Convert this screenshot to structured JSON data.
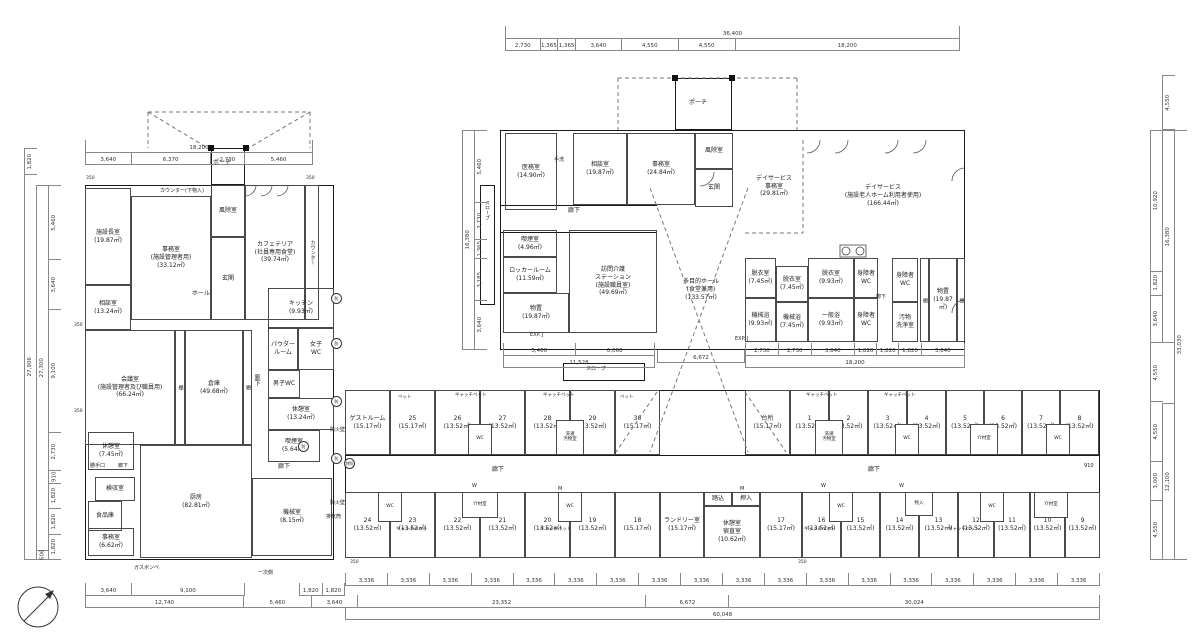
{
  "colors": {
    "background": "#ffffff",
    "line": "#1a1a1a",
    "dim_text": "#333333"
  },
  "rooms": {
    "left": [
      {
        "id": "director-room",
        "lines": [
          "施設長室",
          "(19.87㎡)"
        ]
      },
      {
        "id": "office-admin",
        "lines": [
          "事務室",
          "(施設管理者用)",
          "(33.12㎡)"
        ]
      },
      {
        "id": "windbreak-left",
        "lines": [
          "風除室"
        ]
      },
      {
        "id": "entrance-left",
        "lines": [
          "玄関"
        ]
      },
      {
        "id": "cafeteria",
        "lines": [
          "カフェテリア",
          "(社員専用食堂)",
          "(39.74㎡)"
        ]
      },
      {
        "id": "counter-strip",
        "lines": [
          "カウンター"
        ]
      },
      {
        "id": "consult-left",
        "lines": [
          "相談室",
          "(13.24㎡)"
        ]
      },
      {
        "id": "meeting-room",
        "lines": [
          "会議室",
          "(施設管理者及び職員用)",
          "(66.24㎡)"
        ]
      },
      {
        "id": "shelf-a",
        "lines": [
          "棚"
        ]
      },
      {
        "id": "storage-main",
        "lines": [
          "倉庫",
          "(49.68㎡)"
        ]
      },
      {
        "id": "shelf-b",
        "lines": [
          "棚"
        ]
      },
      {
        "id": "kitchen-unit",
        "lines": [
          "キッチン",
          "(9.93㎡)"
        ]
      },
      {
        "id": "powder-room",
        "lines": [
          "パウダー",
          "ルーム"
        ]
      },
      {
        "id": "womens-wc",
        "lines": [
          "女子",
          "WC"
        ]
      },
      {
        "id": "mens-wc",
        "lines": [
          "男子WC"
        ]
      },
      {
        "id": "break-room-a",
        "lines": [
          "休憩室",
          "(13.24㎡)"
        ]
      },
      {
        "id": "smoking-room-a",
        "lines": [
          "喫煙室",
          "(5.64㎡)"
        ]
      },
      {
        "id": "break-room-b",
        "lines": [
          "休憩室",
          "(7.45㎡)"
        ]
      },
      {
        "id": "receiving-room",
        "lines": [
          "検収室"
        ]
      },
      {
        "id": "food-storage",
        "lines": [
          "食品庫"
        ]
      },
      {
        "id": "office-small",
        "lines": [
          "事務室",
          "(6.62㎡)"
        ]
      },
      {
        "id": "kitchen-main",
        "lines": [
          "厨房",
          "(82.81㎡)"
        ]
      },
      {
        "id": "machine-room",
        "lines": [
          "機械室",
          "(8.15㎡)"
        ]
      }
    ],
    "center": [
      {
        "id": "medical-office",
        "lines": [
          "医務室",
          "(14.90㎡)"
        ]
      },
      {
        "id": "consult-center",
        "lines": [
          "相談室",
          "(19.87㎡)"
        ]
      },
      {
        "id": "office-center",
        "lines": [
          "事務室",
          "(24.84㎡)"
        ]
      },
      {
        "id": "windbreak-center",
        "lines": [
          "風除室"
        ]
      },
      {
        "id": "entrance-center",
        "lines": [
          "玄関"
        ]
      },
      {
        "id": "smoking-room-b",
        "lines": [
          "喫煙室",
          "(4.96㎡)"
        ]
      },
      {
        "id": "locker-room",
        "lines": [
          "ロッカールーム",
          "(11.59㎡)"
        ]
      },
      {
        "id": "storage-west",
        "lines": [
          "物置",
          "(19.87㎡)"
        ]
      },
      {
        "id": "visiting-care-station",
        "lines": [
          "訪問介護",
          "ステーション",
          "(施設職員室)",
          "(49.69㎡)"
        ]
      },
      {
        "id": "multipurpose-hall",
        "lines": [
          "多目的ホール",
          "(食堂兼用)",
          "(133.57㎡)"
        ]
      },
      {
        "id": "dayservice-office",
        "lines": [
          "デイサービス",
          "事務室",
          "(29.81㎡)"
        ]
      },
      {
        "id": "dayservice-room",
        "lines": [
          "デイサービス",
          "(施設老人ホーム利用者使用)",
          "(166.44㎡)"
        ]
      },
      {
        "id": "dressing-a",
        "lines": [
          "脱衣室",
          "(7.45㎡)"
        ]
      },
      {
        "id": "machine-bath-a",
        "lines": [
          "機械浴",
          "(9.93㎡)"
        ]
      },
      {
        "id": "dressing-b",
        "lines": [
          "脱衣室",
          "(7.45㎡)"
        ]
      },
      {
        "id": "machine-bath-b",
        "lines": [
          "機械浴",
          "(7.45㎡)"
        ]
      },
      {
        "id": "dressing-c",
        "lines": [
          "脱衣室",
          "(9.93㎡)"
        ]
      },
      {
        "id": "general-bath",
        "lines": [
          "一般浴",
          "(9.93㎡)"
        ]
      },
      {
        "id": "accessible-wc-a",
        "lines": [
          "身障者",
          "WC"
        ]
      },
      {
        "id": "accessible-wc-b",
        "lines": [
          "身障者",
          "WC"
        ]
      },
      {
        "id": "accessible-wc-c",
        "lines": [
          "身障者",
          "WC"
        ]
      },
      {
        "id": "soiled-washroom",
        "lines": [
          "汚物",
          "洗浄室"
        ]
      },
      {
        "id": "shelf-c",
        "lines": [
          "棚"
        ]
      },
      {
        "id": "storage-east",
        "lines": [
          "物置",
          "(19.87㎡)"
        ]
      },
      {
        "id": "shelf-d",
        "lines": [
          "棚"
        ]
      }
    ],
    "wing_north": [
      {
        "id": "guest-room-west",
        "lines": [
          "ゲストルーム",
          "(15.17㎡)"
        ]
      },
      {
        "id": "room-25",
        "lines": [
          "25",
          "(15.17㎡)"
        ]
      },
      {
        "id": "room-26",
        "lines": [
          "26",
          "(13.52㎡)"
        ]
      },
      {
        "id": "room-27",
        "lines": [
          "27",
          "(13.52㎡)"
        ]
      },
      {
        "id": "room-28",
        "lines": [
          "28",
          "(13.52㎡)"
        ]
      },
      {
        "id": "room-29",
        "lines": [
          "29",
          "(13.52㎡)"
        ]
      },
      {
        "id": "room-30",
        "lines": [
          "30",
          "(15.17㎡)"
        ]
      },
      {
        "id": "kitchen-wing",
        "lines": [
          "台所",
          "(15.17㎡)"
        ]
      },
      {
        "id": "room-1",
        "lines": [
          "1",
          "(13.52㎡)"
        ]
      },
      {
        "id": "room-2",
        "lines": [
          "2",
          "(13.52㎡)"
        ]
      },
      {
        "id": "room-3",
        "lines": [
          "3",
          "(13.52㎡)"
        ]
      },
      {
        "id": "room-4",
        "lines": [
          "4",
          "(13.52㎡)"
        ]
      },
      {
        "id": "room-5",
        "lines": [
          "5",
          "(13.52㎡)"
        ]
      },
      {
        "id": "room-6",
        "lines": [
          "6",
          "(13.52㎡)"
        ]
      },
      {
        "id": "room-7",
        "lines": [
          "7",
          "(13.52㎡)"
        ]
      },
      {
        "id": "room-8",
        "lines": [
          "8",
          "(13.52㎡)"
        ]
      }
    ],
    "wing_south": [
      {
        "id": "room-24",
        "lines": [
          "24",
          "(13.52㎡)"
        ]
      },
      {
        "id": "room-23",
        "lines": [
          "23",
          "(13.52㎡)"
        ]
      },
      {
        "id": "room-22",
        "lines": [
          "22",
          "(13.52㎡)"
        ]
      },
      {
        "id": "room-21",
        "lines": [
          "21",
          "(13.52㎡)"
        ]
      },
      {
        "id": "room-20",
        "lines": [
          "20",
          "(13.52㎡)"
        ]
      },
      {
        "id": "room-19",
        "lines": [
          "19",
          "(13.52㎡)"
        ]
      },
      {
        "id": "room-18",
        "lines": [
          "18",
          "(15.17㎡)"
        ]
      },
      {
        "id": "laundry-room",
        "lines": [
          "ランドリー室",
          "(15.17㎡)"
        ]
      },
      {
        "id": "night-duty-room",
        "lines": [
          "休憩室",
          "宿直室",
          "(10.62㎡)"
        ]
      },
      {
        "id": "fumikomi",
        "lines": [
          "踏込"
        ]
      },
      {
        "id": "oshiire",
        "lines": [
          "押入"
        ]
      },
      {
        "id": "room-17",
        "lines": [
          "17",
          "(15.17㎡)"
        ]
      },
      {
        "id": "room-16",
        "lines": [
          "16",
          "(13.52㎡)"
        ]
      },
      {
        "id": "room-15",
        "lines": [
          "15",
          "(13.52㎡)"
        ]
      },
      {
        "id": "room-14",
        "lines": [
          "14",
          "(13.52㎡)"
        ]
      },
      {
        "id": "room-13",
        "lines": [
          "13",
          "(13.52㎡)"
        ]
      },
      {
        "id": "room-12",
        "lines": [
          "12",
          "(13.52㎡)"
        ]
      },
      {
        "id": "room-11",
        "lines": [
          "11",
          "(13.52㎡)"
        ]
      },
      {
        "id": "room-10",
        "lines": [
          "10",
          "(13.52㎡)"
        ]
      },
      {
        "id": "room-9",
        "lines": [
          "9",
          "(13.52㎡)"
        ]
      }
    ],
    "pods": [
      {
        "id": "pod-wc-n1",
        "lines": [
          "WC"
        ]
      },
      {
        "id": "pod-laundry-n1",
        "lines": [
          "洗濯",
          "汚物室"
        ]
      },
      {
        "id": "pod-laundry-n2",
        "lines": [
          "洗濯",
          "汚物室"
        ]
      },
      {
        "id": "pod-wc-n2",
        "lines": [
          "WC"
        ]
      },
      {
        "id": "pod-kaizai-n",
        "lines": [
          "介材室"
        ]
      },
      {
        "id": "pod-wc-n3",
        "lines": [
          "WC"
        ]
      },
      {
        "id": "pod-wc-s1",
        "lines": [
          "WC"
        ]
      },
      {
        "id": "pod-kaizai-s1",
        "lines": [
          "介材室"
        ]
      },
      {
        "id": "pod-wc-s2",
        "lines": [
          "WC"
        ]
      },
      {
        "id": "pod-wc-s3",
        "lines": [
          "WC"
        ]
      },
      {
        "id": "pod-monoire",
        "lines": [
          "物入"
        ]
      },
      {
        "id": "pod-wc-s4",
        "lines": [
          "WC"
        ]
      },
      {
        "id": "pod-kaizai-s2",
        "lines": [
          "介材室"
        ]
      }
    ]
  },
  "plan_labels": [
    {
      "id": "porch-left",
      "text": "ポーチ"
    },
    {
      "id": "porch-center",
      "text": "ポーチ"
    },
    {
      "id": "hall",
      "text": "ホール"
    },
    {
      "id": "counter-lower",
      "text": "カウンター(下物入)"
    },
    {
      "id": "corridor-left-v",
      "text": "廊下"
    },
    {
      "id": "corridor-left-b",
      "text": "廊下"
    },
    {
      "id": "rear-door",
      "text": "勝手口"
    },
    {
      "id": "corridor-small",
      "text": "廊下"
    },
    {
      "id": "gas-cylinder",
      "text": "ガスボンベ"
    },
    {
      "id": "primary-side",
      "text": "一次側"
    },
    {
      "id": "exhaust-duct",
      "text": "排気筒"
    },
    {
      "id": "fire-wall-a",
      "text": "防火壁"
    },
    {
      "id": "fire-wall-b",
      "text": "防火壁"
    },
    {
      "id": "slope-west",
      "text": "スロープ"
    },
    {
      "id": "slope-south",
      "text": "スロープ"
    },
    {
      "id": "handwash",
      "text": "手洗"
    },
    {
      "id": "corridor-center",
      "text": "廊下"
    },
    {
      "id": "corridor-bath",
      "text": "廊下"
    },
    {
      "id": "corridor-wing-west",
      "text": "廊下"
    },
    {
      "id": "corridor-wing-east",
      "text": "廊下"
    },
    {
      "id": "expj-west",
      "text": "EXP. J"
    },
    {
      "id": "expj-east",
      "text": "EXP. J"
    },
    {
      "id": "bed-a",
      "text": "ベット"
    },
    {
      "id": "bed-b",
      "text": "ベット"
    },
    {
      "id": "gatch-bed-1",
      "text": "ギャッチベット"
    },
    {
      "id": "gatch-bed-2",
      "text": "ギャッチベット"
    },
    {
      "id": "gatch-bed-3",
      "text": "ギャッチベット"
    },
    {
      "id": "gatch-bed-4",
      "text": "ギャッチベット"
    },
    {
      "id": "gatch-bed-5",
      "text": "ギャッチベット"
    },
    {
      "id": "gatch-bed-6",
      "text": "ギャッチベット"
    },
    {
      "id": "gatch-bed-7",
      "text": "ギャッチベット"
    },
    {
      "id": "gatch-bed-8",
      "text": "ギャッチベット"
    },
    {
      "id": "w-mark-1",
      "text": "W"
    },
    {
      "id": "w-mark-2",
      "text": "W"
    },
    {
      "id": "w-mark-3",
      "text": "W"
    },
    {
      "id": "m-mark-1",
      "text": "M"
    },
    {
      "id": "m-mark-2",
      "text": "M"
    },
    {
      "id": "dim-910",
      "text": "910"
    },
    {
      "id": "offset-350-a",
      "text": "350"
    },
    {
      "id": "offset-350-b",
      "text": "350"
    },
    {
      "id": "offset-350-c",
      "text": "350"
    },
    {
      "id": "offset-350-d",
      "text": "350"
    },
    {
      "id": "offset-350-e",
      "text": "350"
    },
    {
      "id": "offset-350-f",
      "text": "350"
    },
    {
      "id": "fire-door-1",
      "text": "防"
    },
    {
      "id": "fire-door-2",
      "text": "防"
    },
    {
      "id": "fire-door-3",
      "text": "防"
    },
    {
      "id": "fire-door-4",
      "text": "防"
    },
    {
      "id": "fire-door-5",
      "text": "防"
    },
    {
      "id": "fire-door-special",
      "text": "特防"
    }
  ],
  "dims": {
    "top_total": "36,400",
    "top_seg": [
      "2,730",
      "1,365",
      "1,365",
      "3,640",
      "4,550",
      "4,550",
      "18,200"
    ],
    "lb_total": "18,200",
    "lb_seg": [
      "3,640",
      "6,370",
      "2,730",
      "5,460"
    ],
    "below_a": [
      "5,460",
      "6,068"
    ],
    "below_a_total": "11,528",
    "below_b": "6,672",
    "bath_seg": [
      "2,730",
      "2,730",
      "3,640",
      "1,820",
      "1,820",
      "1,820",
      "3,640"
    ],
    "bath_total": "18,200",
    "bottom_bays": [
      "3,336",
      "3,336",
      "3,336",
      "3,336",
      "3,336",
      "3,336",
      "3,336",
      "3,336",
      "3,336",
      "3,336",
      "3,336",
      "3,336",
      "3,336",
      "3,336",
      "3,336",
      "3,336",
      "3,336",
      "3,336"
    ],
    "bottom_l1": [
      "3,640",
      "9,100"
    ],
    "bottom_l2": [
      "1,820",
      "1,820"
    ],
    "bottom_sub": [
      "12,740",
      "5,460",
      "3,640",
      "23,352",
      "6,672",
      "30,024"
    ],
    "bottom_total": "60,048",
    "left_outer": [
      "1,820",
      "27,906"
    ],
    "left_mid": [
      "27,300",
      "606"
    ],
    "left_seg": [
      "5,460",
      "3,640",
      "9,100",
      "2,730",
      "910",
      "1,820",
      "1,820",
      "1,820"
    ],
    "cl_total": "16,380",
    "cl_seg": [
      "5,460",
      "2,730",
      "1,365",
      "3,185",
      "3,640"
    ],
    "right_top": "4,550",
    "right_seg": [
      "10,920",
      "1,820",
      "3,640",
      "4,550",
      "4,550",
      "3,000",
      "4,550"
    ],
    "right_mid_a": "16,380",
    "right_mid_b": "12,100",
    "right_total": "33,030"
  }
}
